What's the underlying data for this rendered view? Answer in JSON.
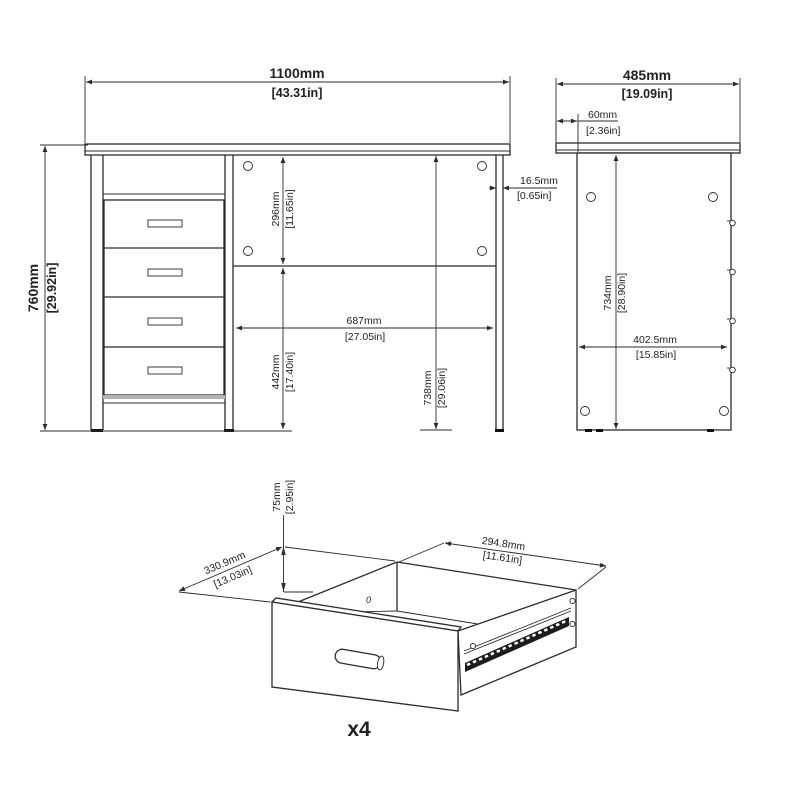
{
  "front": {
    "width_mm": "1100mm",
    "width_in": "[43.31in]",
    "height_mm": "760mm",
    "height_in": "[29.92in]",
    "back_panel_mm": "296mm",
    "back_panel_in": "[11.65in]",
    "panel_thickness_mm": "16.5mm",
    "panel_thickness_in": "[0.65in]",
    "knee_space_mm": "687mm",
    "knee_space_in": "[27.05in]",
    "under_drawer_mm": "442mm",
    "under_drawer_in": "[17.40in]",
    "under_top_mm": "738mm",
    "under_top_in": "[29.06in]"
  },
  "side": {
    "depth_mm": "485mm",
    "depth_in": "[19.09in]",
    "overhang_mm": "60mm",
    "overhang_in": "[2.36in]",
    "panel_height_mm": "734mm",
    "panel_height_in": "[28.90in]",
    "panel_depth_mm": "402.5mm",
    "panel_depth_in": "[15.85in]"
  },
  "drawer": {
    "height_mm": "75mm",
    "height_in": "[2.95in]",
    "depth_mm": "330.9mm",
    "depth_in": "[13.03in]",
    "width_mm": "294.8mm",
    "width_in": "[11.61in]",
    "quantity": "x4",
    "zero_mark": "0"
  },
  "colors": {
    "line": "#2b2b2b",
    "background": "#ffffff",
    "rail_dark": "#1c1c1c",
    "kick_gray": "#b3b3b3"
  }
}
